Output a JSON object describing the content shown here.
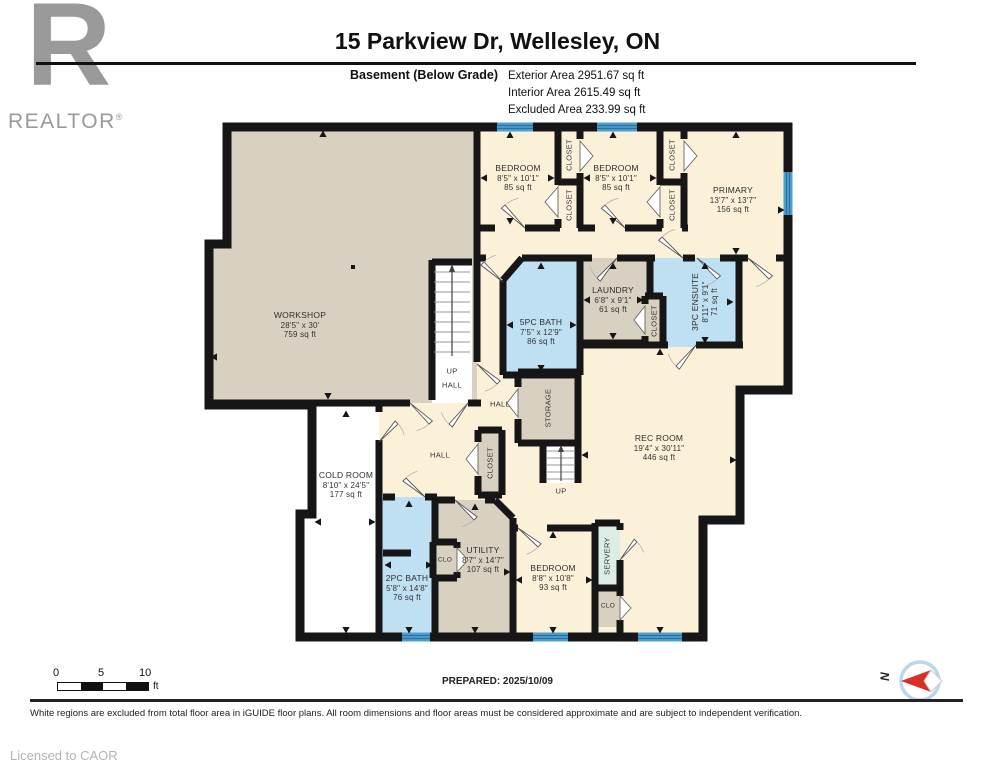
{
  "header": {
    "title": "15 Parkview Dr, Wellesley, ON",
    "floor_label": "Basement (Below Grade)",
    "area_lines": [
      "Exterior Area 2951.67 sq ft",
      "Interior Area 2615.49 sq ft",
      "Excluded Area 233.99 sq ft"
    ]
  },
  "logo": {
    "glyph": "R",
    "label": "REALTOR",
    "registered": "®"
  },
  "rooms": [
    {
      "name": "WORKSHOP",
      "dims": "28'5\" x 30'",
      "area": "759 sq ft"
    },
    {
      "name": "BEDROOM",
      "dims": "8'5\" x 10'1\"",
      "area": "85 sq ft"
    },
    {
      "name": "BEDROOM",
      "dims": "8'5\" x 10'1\"",
      "area": "85 sq ft"
    },
    {
      "name": "PRIMARY",
      "dims": "13'7\" x 13'7\"",
      "area": "156 sq ft"
    },
    {
      "name": "5PC BATH",
      "dims": "7'5\" x 12'9\"",
      "area": "86 sq ft"
    },
    {
      "name": "LAUNDRY",
      "dims": "6'8\" x 9'1\"",
      "area": "61 sq ft"
    },
    {
      "name": "3PC ENSUITE",
      "dims": "8'11\" x 9'1\"",
      "area": "71 sq ft"
    },
    {
      "name": "REC ROOM",
      "dims": "19'4\" x 30'11\"",
      "area": "446 sq ft"
    },
    {
      "name": "COLD ROOM",
      "dims": "8'10\" x 24'5\"",
      "area": "177 sq ft"
    },
    {
      "name": "UTILITY",
      "dims": "8'7\" x 14'7\"",
      "area": "107 sq ft"
    },
    {
      "name": "BEDROOM",
      "dims": "8'8\" x 10'8\"",
      "area": "93 sq ft"
    },
    {
      "name": "2PC BATH",
      "dims": "5'8\" x 14'8\"",
      "area": "76 sq ft"
    }
  ],
  "labels": {
    "closet": "CLOSET",
    "storage": "STORAGE",
    "servery": "SERVERY",
    "clo": "CLO",
    "hall": "HALL",
    "up": "UP"
  },
  "scale": {
    "ticks": [
      "0",
      "5",
      "10"
    ],
    "unit": "ft"
  },
  "compass": {
    "north": "N"
  },
  "footer": {
    "prepared": "PREPARED: 2025/10/09",
    "disclaimer": "White regions are excluded from total floor area in iGUIDE floor plans. All room dimensions and floor areas must be considered approximate and are subject to independent verification.",
    "license": "Licensed to CAOR"
  },
  "colors": {
    "wall": "#161616",
    "room_cream": "#FAF1D8",
    "room_tan": "#D8D0C0",
    "room_blue": "#BFDFF2",
    "servery_green": "#DBEDE4",
    "window_blue": "#4D9FCE",
    "excluded_white": "#FFFFFF"
  }
}
